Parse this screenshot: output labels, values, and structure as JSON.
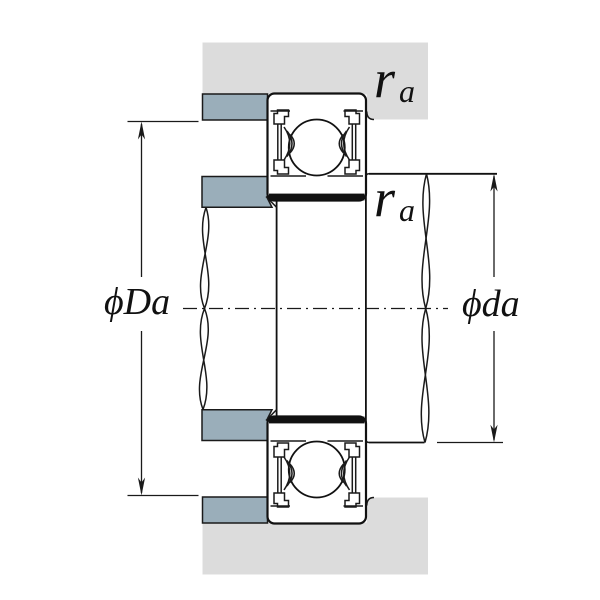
{
  "figure": {
    "type": "bearing-mounting-cross-section-diagram",
    "colors": {
      "background": "#ffffff",
      "housing_fill": "#dcdcdc",
      "shoulder_fill": "#9aaeba",
      "line": "#1a1a1a"
    },
    "labels": {
      "housing_abutment_diameter": "ϕDa",
      "shaft_abutment_diameter": "ϕda",
      "fillet_housing": {
        "symbol": "r",
        "sub": "a"
      },
      "fillet_shaft": {
        "symbol": "r",
        "sub": "a"
      }
    }
  }
}
